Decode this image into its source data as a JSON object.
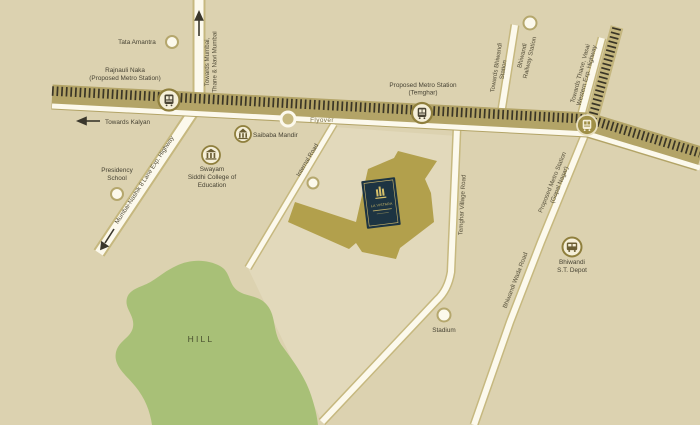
{
  "map": {
    "type": "project-location-map",
    "colors": {
      "background": "#dcd2b0",
      "road_fill": "#fcf9ec",
      "road_casing": "#c6b87f",
      "flyover_band": "#b3a467",
      "railway_ties": "#3a3526",
      "project_site_gold": "#b2a04c",
      "hill_green": "#a8c077",
      "logo_navy": "#1d3442",
      "logo_gold": "#d6c06a",
      "label_text": "#474334"
    }
  },
  "labels": {
    "tata_amantra": "Tata Amantra",
    "rajnauli_line1": "Rajnauli Naka",
    "rajnauli_line2": "(Proposed Metro Station)",
    "towards_kalyan": "Towards Kalyan",
    "towards_mumbai_line1": "Towards Mumbai,",
    "towards_mumbai_line2": "Thane & Navi Mumbai",
    "flyover": "Flyover",
    "temghar_station_line1": "Proposed Metro Station",
    "temghar_station_line2": "(Temghar)",
    "towards_bhiwandi_line1": "Towards Bhiwandi",
    "towards_bhiwandi_line2": "Station",
    "bhiwandi_railway_line1": "Bhiwandi",
    "bhiwandi_railway_line2": "Railway Station",
    "towards_thane_line1": "Towards Thane, Vasai",
    "towards_thane_line2": "Western Exp. Highway",
    "gopal_nagar_line1": "Proposed Metro Station",
    "gopal_nagar_line2": "(Gopal Nagar)",
    "saibaba_mandir": "Saibaba Mandir",
    "swayam_line1": "Swayam",
    "swayam_line2": "Siddhi College of",
    "swayam_line3": "Education",
    "presidency_line1": "Presidency",
    "presidency_line2": "School",
    "mumbai_nashik_highway": "Mumbai-Nashik 8 Lane Exp. Highway",
    "internal_road": "Internal Road",
    "temghar_village_road": "Temghar Village Road",
    "bhiwandi_wada_road": "Bhiwandi Wada Road",
    "st_depot_line1": "Bhiwandi",
    "st_depot_line2": "S.T. Depot",
    "stadium": "Stadium",
    "hill": "HILL"
  },
  "project": {
    "logo_text": "LA VISTARA"
  }
}
